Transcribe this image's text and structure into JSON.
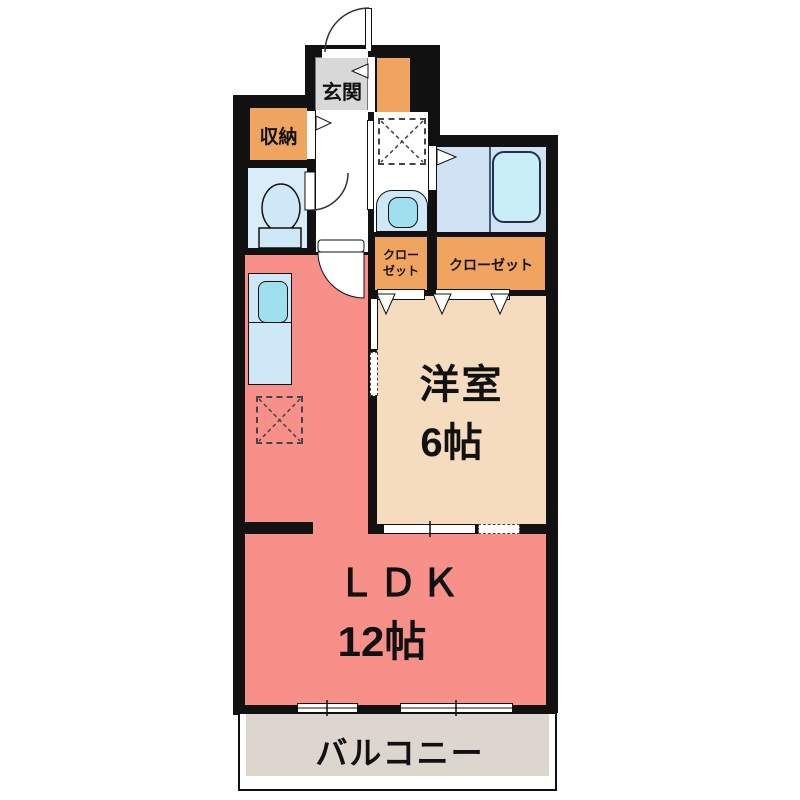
{
  "plan_title": "apartment-floor-plan",
  "rooms": {
    "entrance": {
      "label": "玄関"
    },
    "storage": {
      "label": "収納"
    },
    "closet_small": {
      "line1": "クロー",
      "line2": "ゼット"
    },
    "closet_large": {
      "label": "クローゼット"
    },
    "western": {
      "label": "洋室",
      "size": "6帖"
    },
    "ldk": {
      "label": "ＬＤＫ",
      "size": "12帖"
    },
    "balcony": {
      "label": "バルコニー"
    }
  },
  "fixtures": [
    "toilet-icon",
    "bathtub-icon",
    "kitchen-sink-icon",
    "washbasin-icon",
    "washing-machine-space",
    "refrigerator-space"
  ],
  "colors": {
    "wall": "#111111",
    "accent_orange": "#efa55f",
    "ldk_salmon": "#f8908a",
    "western_beige": "#f5dcbf",
    "balcony_beige": "#ddd6ce",
    "wet_room_blue": "#d9ecfa",
    "fixture_blue": "#cfe8f7",
    "sink_cyan": "#9fdfee",
    "bathtub_cyan": "#c9eef8",
    "entrance_gray": "#d8d8d8"
  }
}
